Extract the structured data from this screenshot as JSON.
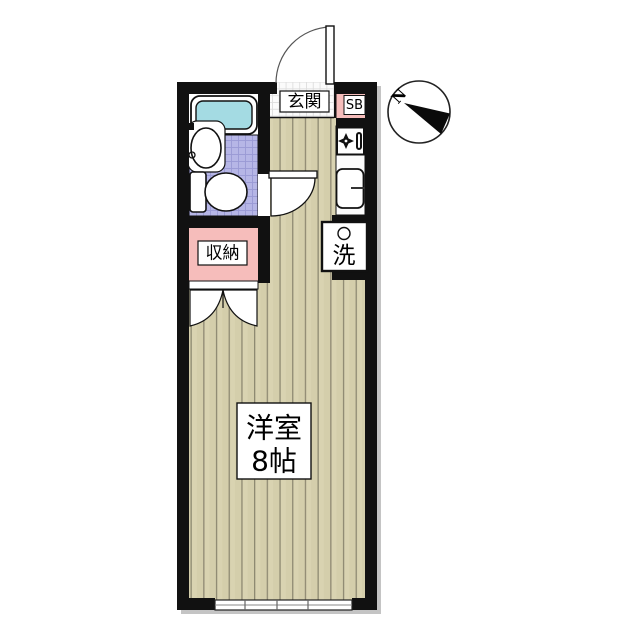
{
  "page": {
    "background": "#ffffff"
  },
  "floor_plan": {
    "kind": "studio-apartment-floor-plan",
    "labels": {
      "entrance": "玄関",
      "shoe_box": "SB",
      "storage": "収納",
      "laundry": "洗",
      "room_name": "洋室",
      "room_size": "8帖"
    },
    "compass": {
      "north": "N"
    },
    "colors": {
      "wall": "#111111",
      "flooring": "#d9d3b1",
      "flooring_line": "#8e8972",
      "pink": "#f6bdbb",
      "bath_tile": "#b6b6e6",
      "bath_tile_line": "#9a9ad4",
      "bathtub": "#a4dbe3",
      "entrance_tile": "#fbfbfb",
      "shadow": "#c4c4c4"
    }
  }
}
